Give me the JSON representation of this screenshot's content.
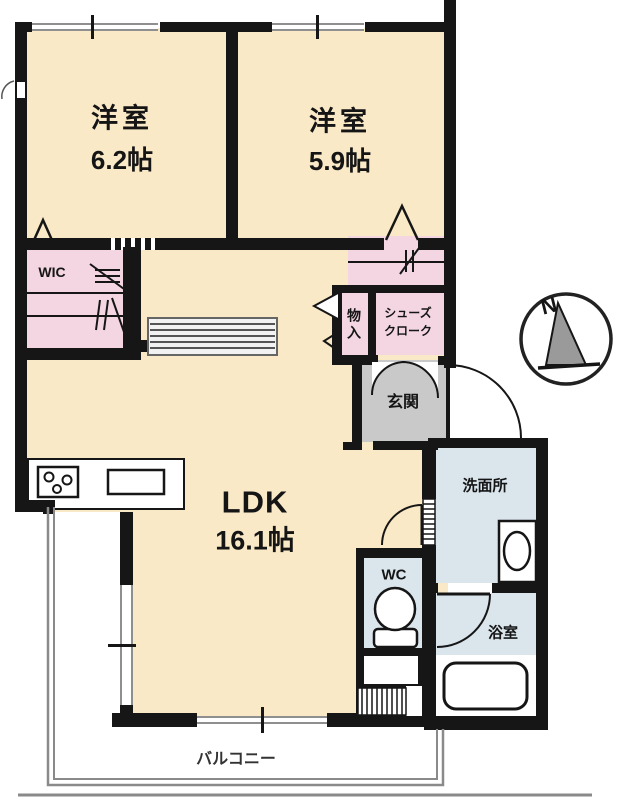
{
  "colors": {
    "wall": "#161616",
    "room_cream": "#FAE9C6",
    "closet_pink": "#F3D6E1",
    "entry_gray": "#C9C9C9",
    "wet_blue": "#DAE5EC",
    "balcony_line": "#8a8a8a"
  },
  "rooms": {
    "bedroom1": {
      "name": "洋室",
      "size": "6.2帖"
    },
    "bedroom2": {
      "name": "洋室",
      "size": "5.9帖"
    },
    "wic": {
      "name": "WIC"
    },
    "storage": {
      "name": "物入"
    },
    "shoe_closet": {
      "line1": "シューズ",
      "line2": "クローク"
    },
    "entry": {
      "name": "玄関"
    },
    "washroom": {
      "name": "洗面所"
    },
    "toilet": {
      "name": "WC"
    },
    "bathroom": {
      "name": "浴室"
    },
    "ldk": {
      "name": "LDK",
      "size": "16.1帖"
    },
    "balcony": {
      "name": "バルコニー"
    }
  },
  "compass": {
    "north_label": "N"
  }
}
